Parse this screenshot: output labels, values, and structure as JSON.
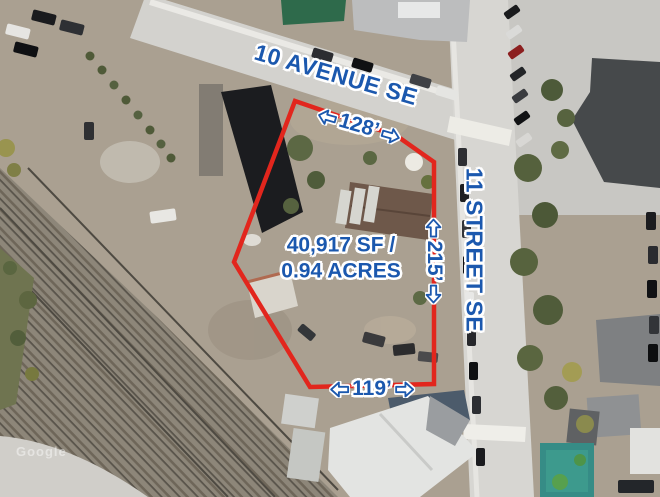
{
  "colors": {
    "boundary_red": "#e2261d",
    "label_blue": "#1b58ae",
    "halo_white": "#ffffff",
    "arrow_fill": "#ffffff"
  },
  "streets": {
    "avenue": "10 AVENUE SE",
    "street": "11 STREET SE"
  },
  "parcel": {
    "area_line1": "40,917 SF /",
    "area_line2": "0.94 ACRES",
    "dim_top": "128’",
    "dim_right": "215’",
    "dim_bottom": "119’"
  },
  "watermark": "Google"
}
